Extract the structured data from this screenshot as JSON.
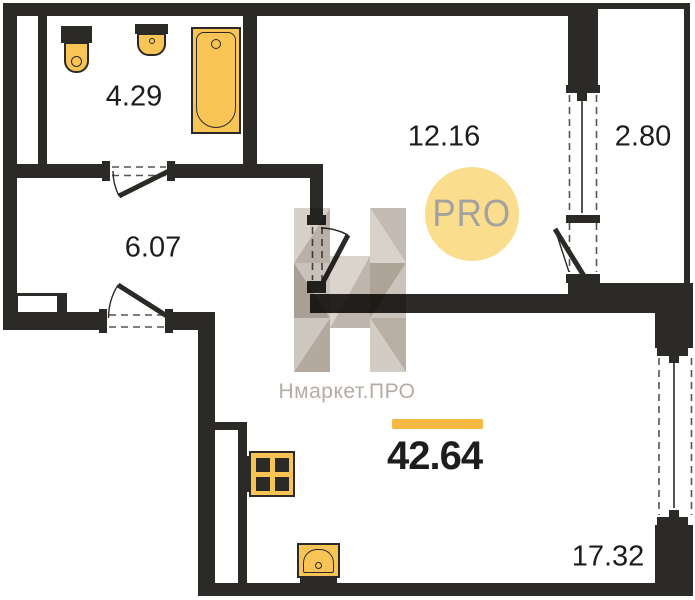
{
  "floor_plan": {
    "total_area_label": "42.64",
    "badge_label": "PRO",
    "watermark_label": "Нмаркет.ПРО",
    "rooms": [
      {
        "name": "bathroom",
        "area_label": "4.29"
      },
      {
        "name": "hallway",
        "area_label": "6.07"
      },
      {
        "name": "room",
        "area_label": "12.16"
      },
      {
        "name": "balcony",
        "area_label": "2.80"
      },
      {
        "name": "kitchen-living",
        "area_label": "17.32"
      }
    ],
    "fixtures": [
      "toilet",
      "sink",
      "bathtub",
      "stove",
      "kitchen-sink"
    ],
    "colors": {
      "wall": "#2b2a27",
      "fixture_fill": "#f8c455",
      "accent_bar": "#f5b843",
      "badge_fill": "#fbdd8e",
      "badge_text": "#a2a2a0",
      "watermark_text": "#b4ada6",
      "dash": "#55544f"
    }
  }
}
